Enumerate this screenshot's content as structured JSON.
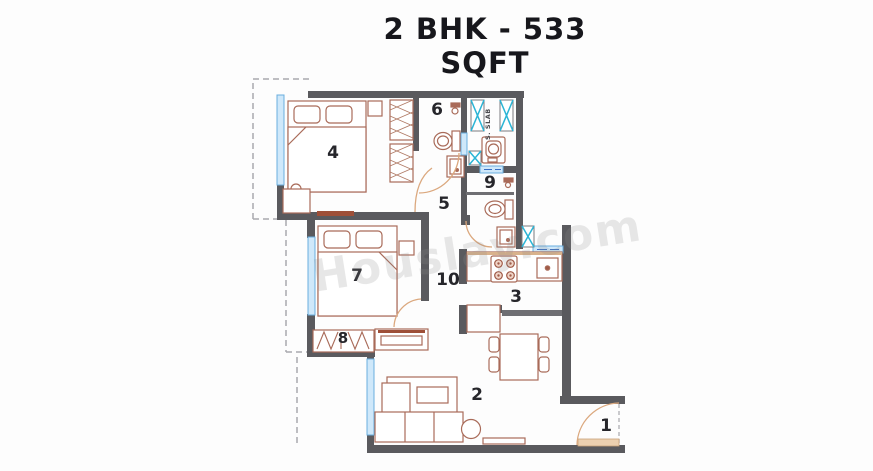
{
  "title": "2 BHK - 533 SQFT",
  "watermark": "Houslay.com",
  "service_slab_label": "S. SLAB",
  "rooms": [
    {
      "label": "1"
    },
    {
      "label": "2"
    },
    {
      "label": "3"
    },
    {
      "label": "4"
    },
    {
      "label": "5"
    },
    {
      "label": "6"
    },
    {
      "label": "7"
    },
    {
      "label": "8"
    },
    {
      "label": "9"
    },
    {
      "label": "10"
    }
  ],
  "colors": {
    "wall": "#5a5a5e",
    "window_fill": "#cfe8fa",
    "window_border": "#6aaede",
    "furniture_line": "#a96b59",
    "duct_x": "#2ab5d6",
    "door_arc": "#dba87e",
    "sill_accent": "#9e4f38",
    "label_text": "#26262b"
  }
}
